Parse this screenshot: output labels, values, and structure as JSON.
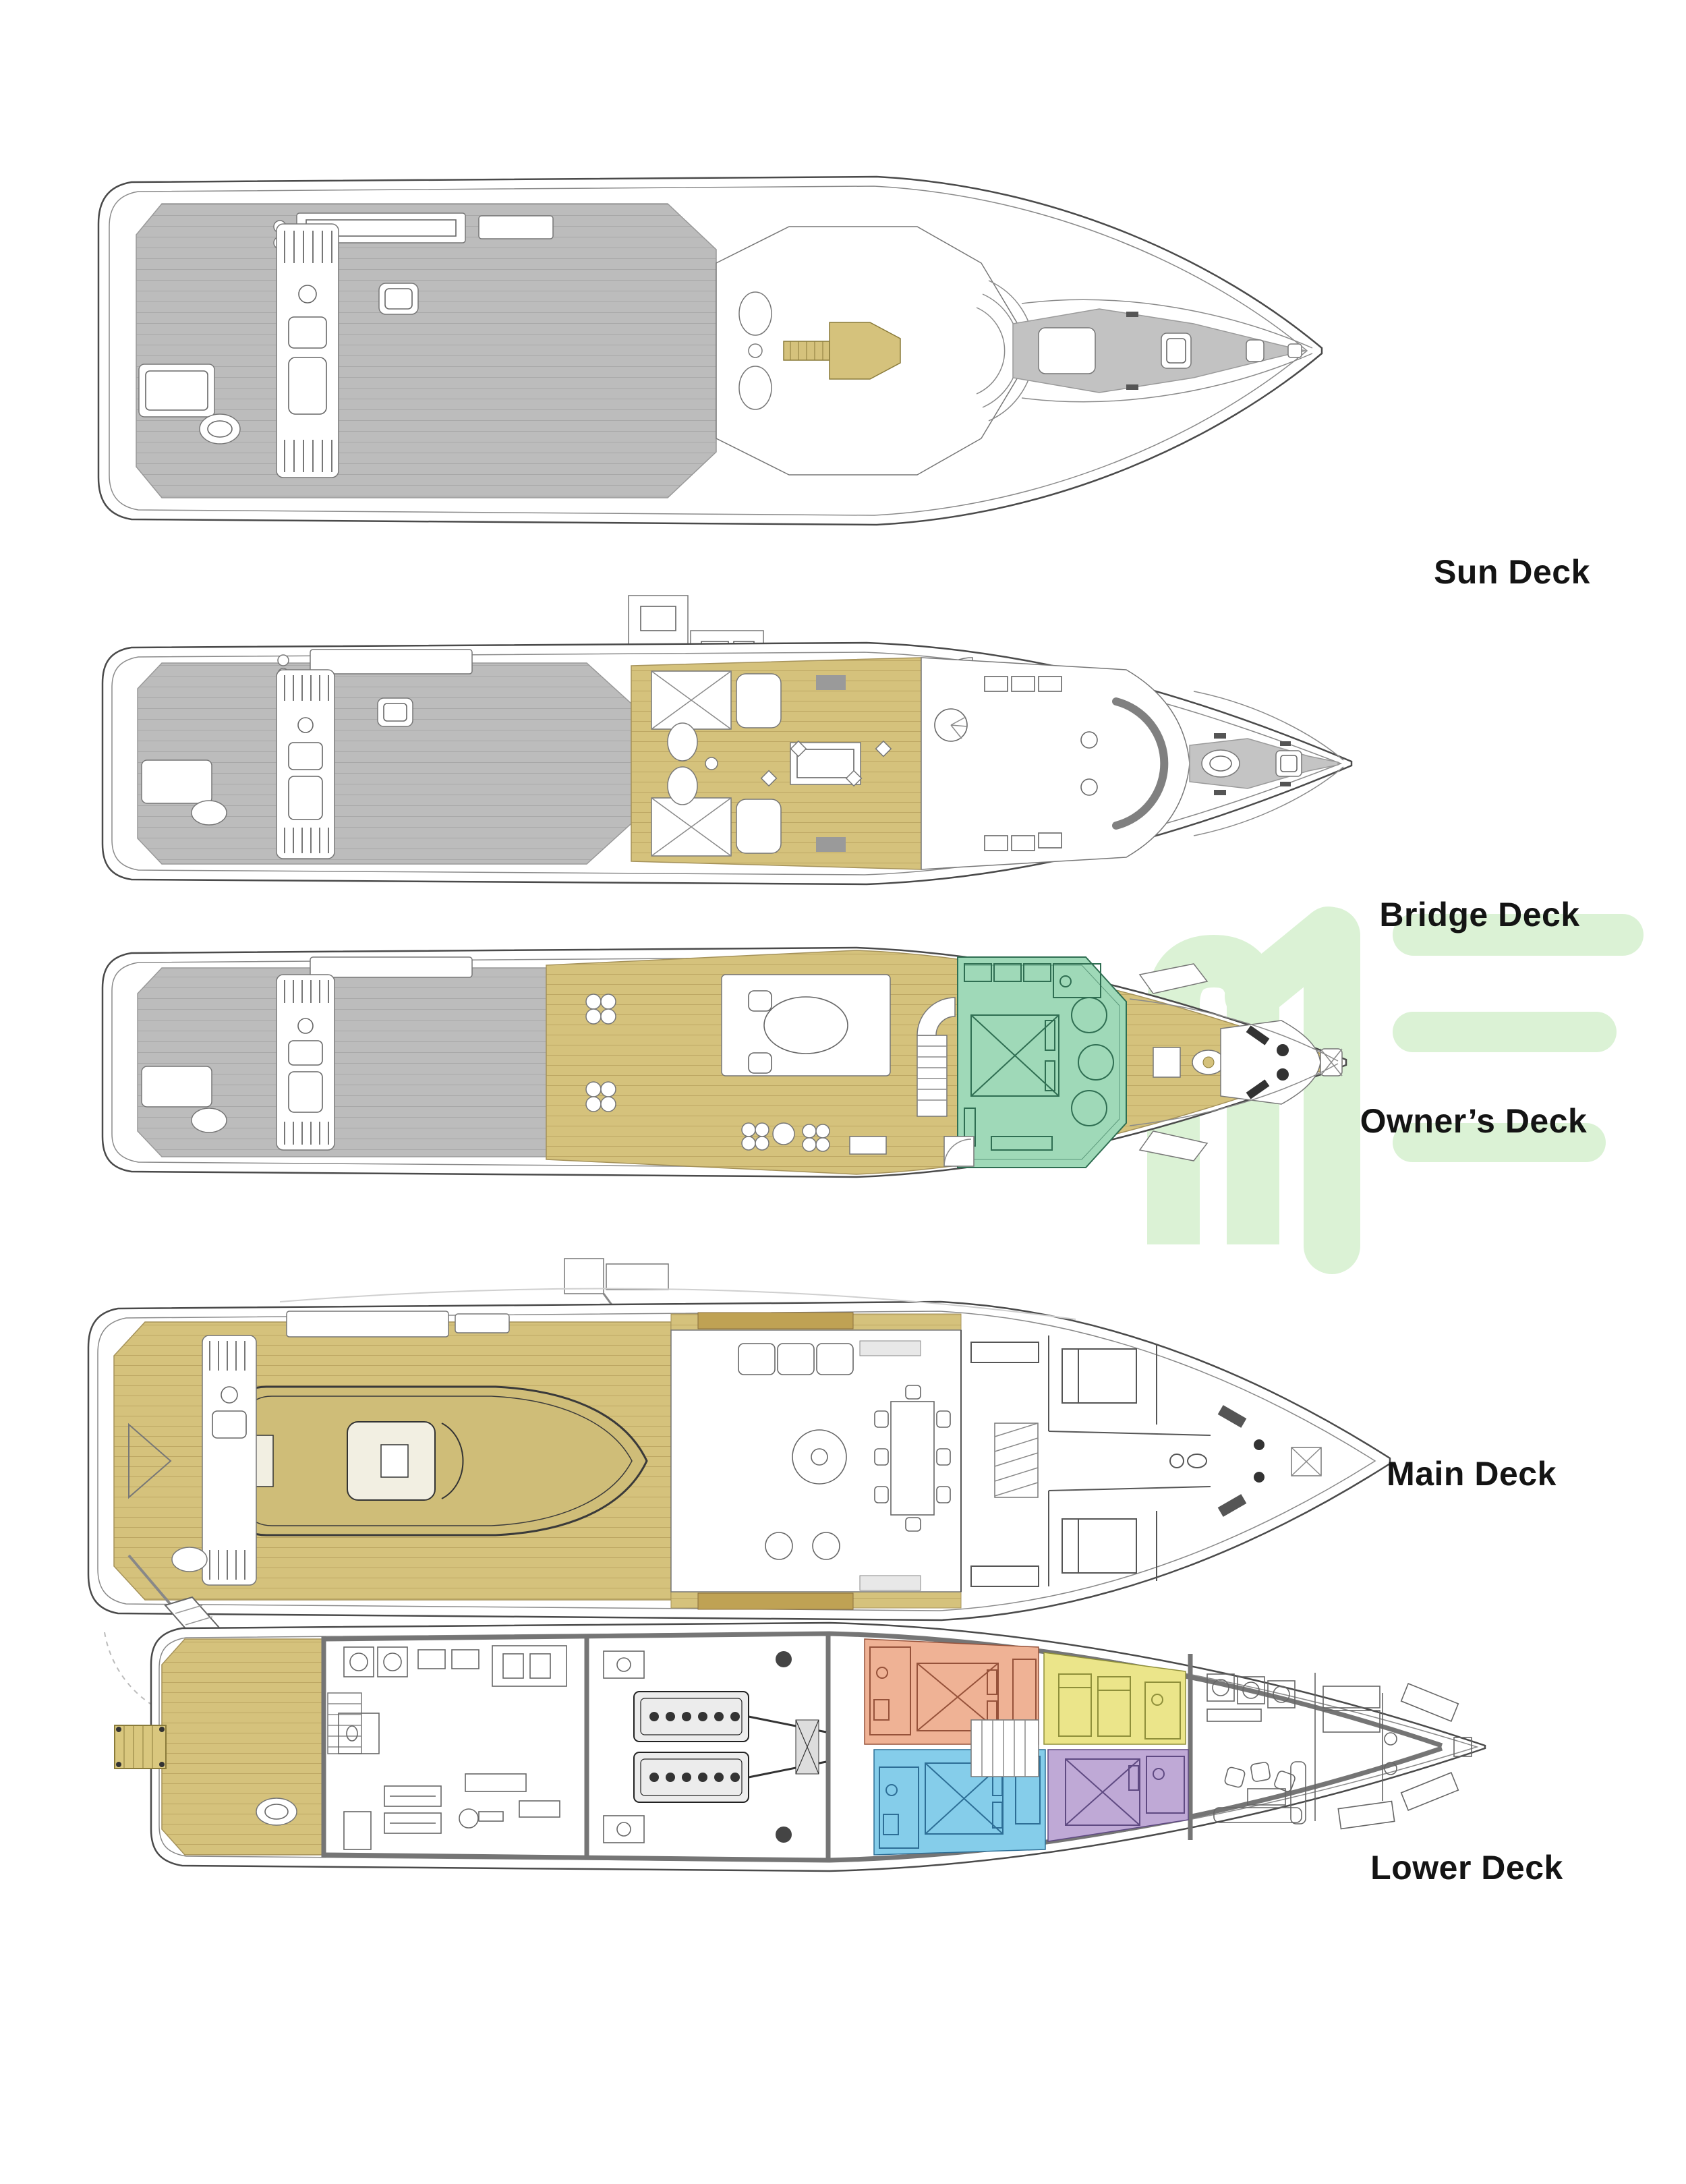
{
  "page": {
    "background": "#ffffff"
  },
  "decks": [
    {
      "id": "sun-deck",
      "label": "Sun Deck"
    },
    {
      "id": "bridge-deck",
      "label": "Bridge Deck"
    },
    {
      "id": "owners-deck",
      "label": "Owner’s Deck"
    },
    {
      "id": "main-deck",
      "label": "Main Deck"
    },
    {
      "id": "lower-deck",
      "label": "Lower Deck"
    }
  ],
  "palette": {
    "bg": "#ffffff",
    "label": "#141414",
    "outline": "#4a4a4a",
    "gray": "#bcbcbc",
    "gold": "#d5c27c",
    "gold_dark": "#a5925a",
    "green": "#9fd9b8",
    "green_dark": "#2f6e52",
    "salmon": "#efb295",
    "blue": "#85cdea",
    "yellow": "#ebe58a",
    "purple": "#bfa9d6",
    "watermark": "#dbf2d5"
  },
  "watermark": {
    "name": "green-letterform-watermark",
    "color": "#dbf2d5"
  }
}
